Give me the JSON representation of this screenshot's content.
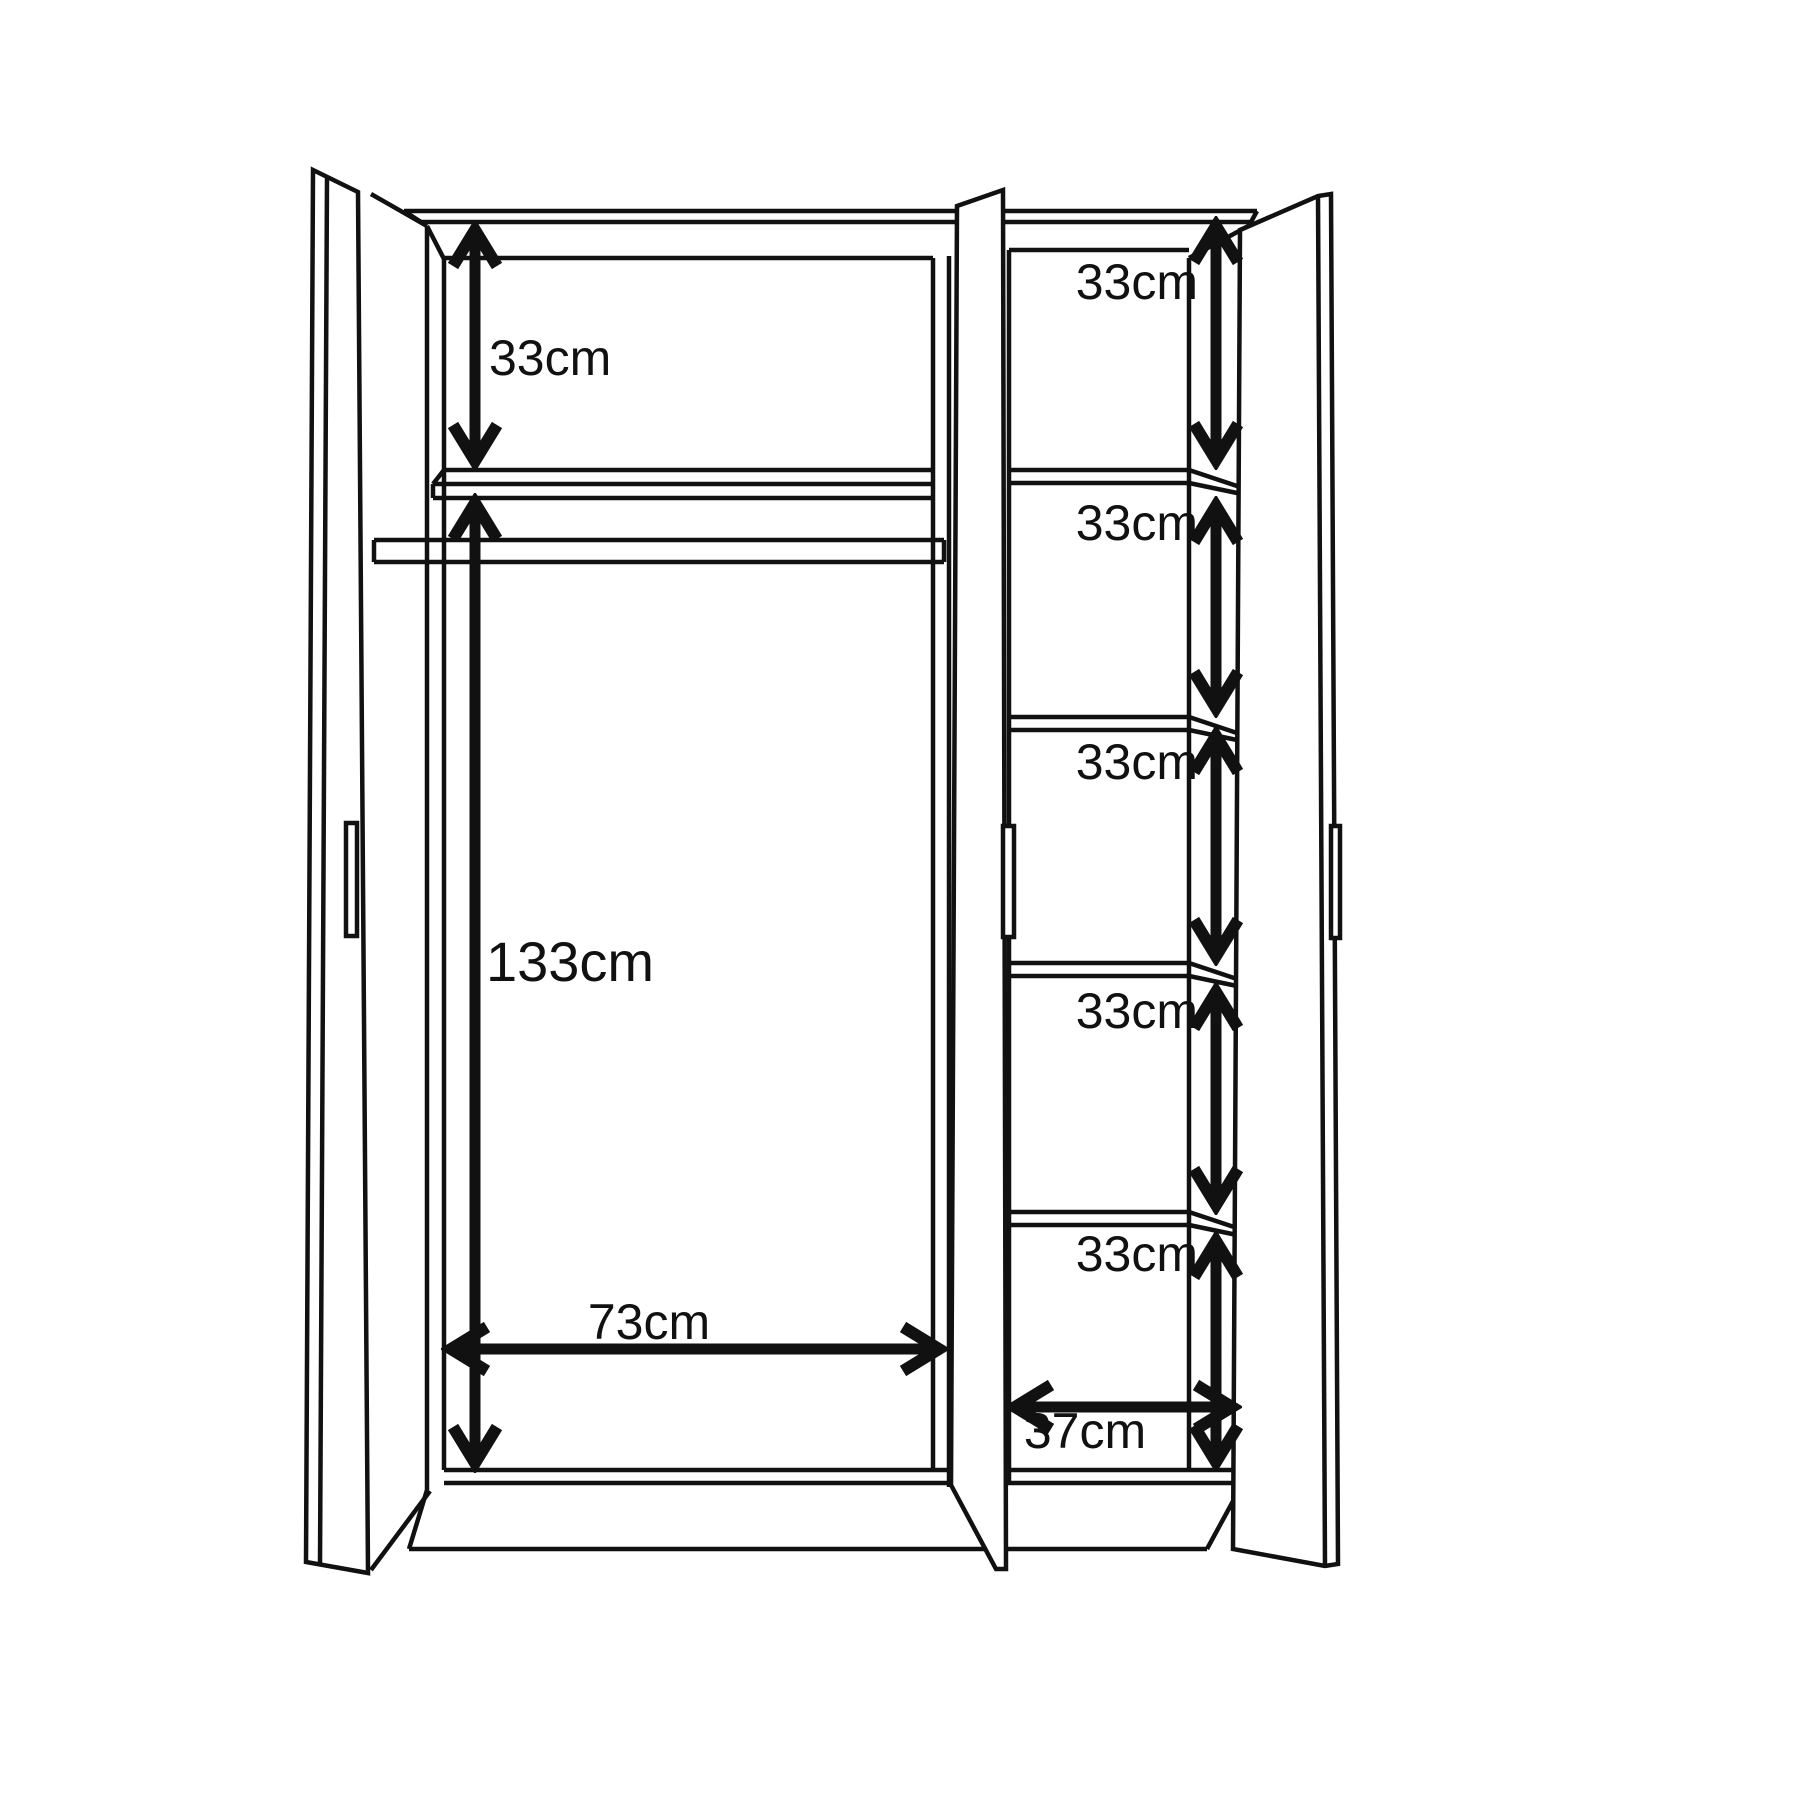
{
  "page": {
    "background": "#ffffff",
    "line_color": "#111111"
  },
  "diagram": {
    "subject": "three-door wardrobe interior dimension drawing",
    "unit": "cm",
    "labels": {
      "left_top_compartment_height": "33cm",
      "hanging_space_height": "133cm",
      "hanging_space_width": "73cm",
      "right_compartment_heights": [
        "33cm",
        "33cm",
        "33cm",
        "33cm",
        "33cm"
      ],
      "right_compartment_width": "37cm"
    }
  }
}
